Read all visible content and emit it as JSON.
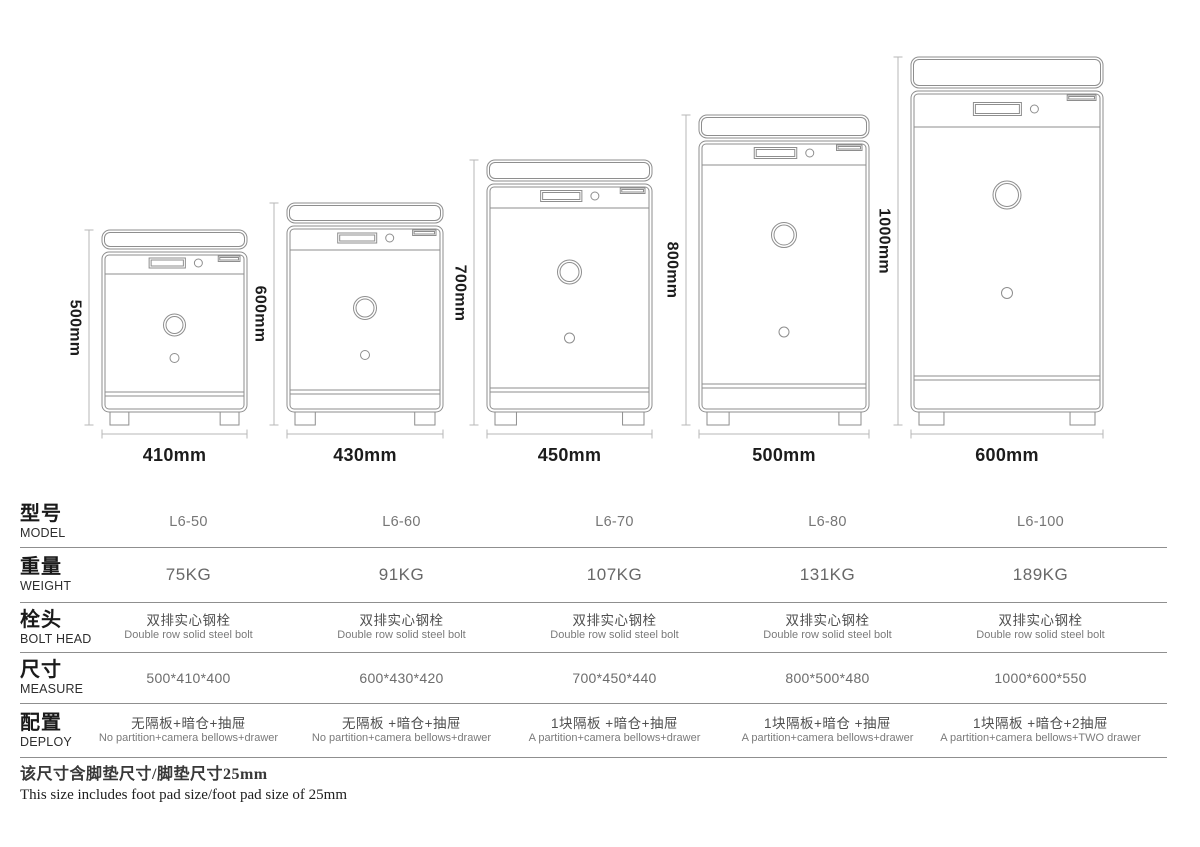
{
  "diagram": {
    "safes": [
      {
        "model": "L6-50",
        "height_label": "500mm",
        "width_label": "410mm"
      },
      {
        "model": "L6-60",
        "height_label": "600mm",
        "width_label": "430mm"
      },
      {
        "model": "L6-70",
        "height_label": "700mm",
        "width_label": "450mm"
      },
      {
        "model": "L6-80",
        "height_label": "800mm",
        "width_label": "500mm"
      },
      {
        "model": "L6-100",
        "height_label": "1000mm",
        "width_label": "600mm"
      }
    ]
  },
  "table": {
    "rows": [
      {
        "label_zh": "型号",
        "label_en": "MODEL",
        "values": [
          "L6-50",
          "L6-60",
          "L6-70",
          "L6-80",
          "L6-100"
        ]
      },
      {
        "label_zh": "重量",
        "label_en": "WEIGHT",
        "values": [
          "75KG",
          "91KG",
          "107KG",
          "131KG",
          "189KG"
        ]
      },
      {
        "label_zh": "栓头",
        "label_en": "BOLT HEAD",
        "values": [
          {
            "zh": "双排实心钢栓",
            "en": "Double row solid steel bolt"
          },
          {
            "zh": "双排实心钢栓",
            "en": "Double row solid steel bolt"
          },
          {
            "zh": "双排实心钢栓",
            "en": "Double row solid steel bolt"
          },
          {
            "zh": "双排实心钢栓",
            "en": "Double row solid steel bolt"
          },
          {
            "zh": "双排实心钢栓",
            "en": "Double row solid steel bolt"
          }
        ]
      },
      {
        "label_zh": "尺寸",
        "label_en": "MEASURE",
        "values": [
          "500*410*400",
          "600*430*420",
          "700*450*440",
          "800*500*480",
          "1000*600*550"
        ]
      },
      {
        "label_zh": "配置",
        "label_en": "DEPLOY",
        "values": [
          {
            "zh": "无隔板+暗仓+抽屉",
            "en": "No partition+camera bellows+drawer"
          },
          {
            "zh": "无隔板 +暗仓+抽屉",
            "en": "No partition+camera bellows+drawer"
          },
          {
            "zh": "1块隔板 +暗仓+抽屉",
            "en": "A partition+camera bellows+drawer"
          },
          {
            "zh": "1块隔板+暗仓 +抽屉",
            "en": "A partition+camera bellows+drawer"
          },
          {
            "zh": "1块隔板 +暗仓+2抽屉",
            "en": "A partition+camera bellows+TWO drawer"
          }
        ]
      }
    ]
  },
  "footnote": {
    "zh": "该尺寸含脚垫尺寸/脚垫尺寸25mm",
    "en": "This size includes foot pad size/foot pad size of 25mm"
  },
  "colors": {
    "line_art": "#8e8e8e",
    "dimension_line": "#b7b7b7",
    "separator": "#8f8f8f",
    "text_dark": "#1c1c1c",
    "text_gray": "#6c6c6c"
  }
}
